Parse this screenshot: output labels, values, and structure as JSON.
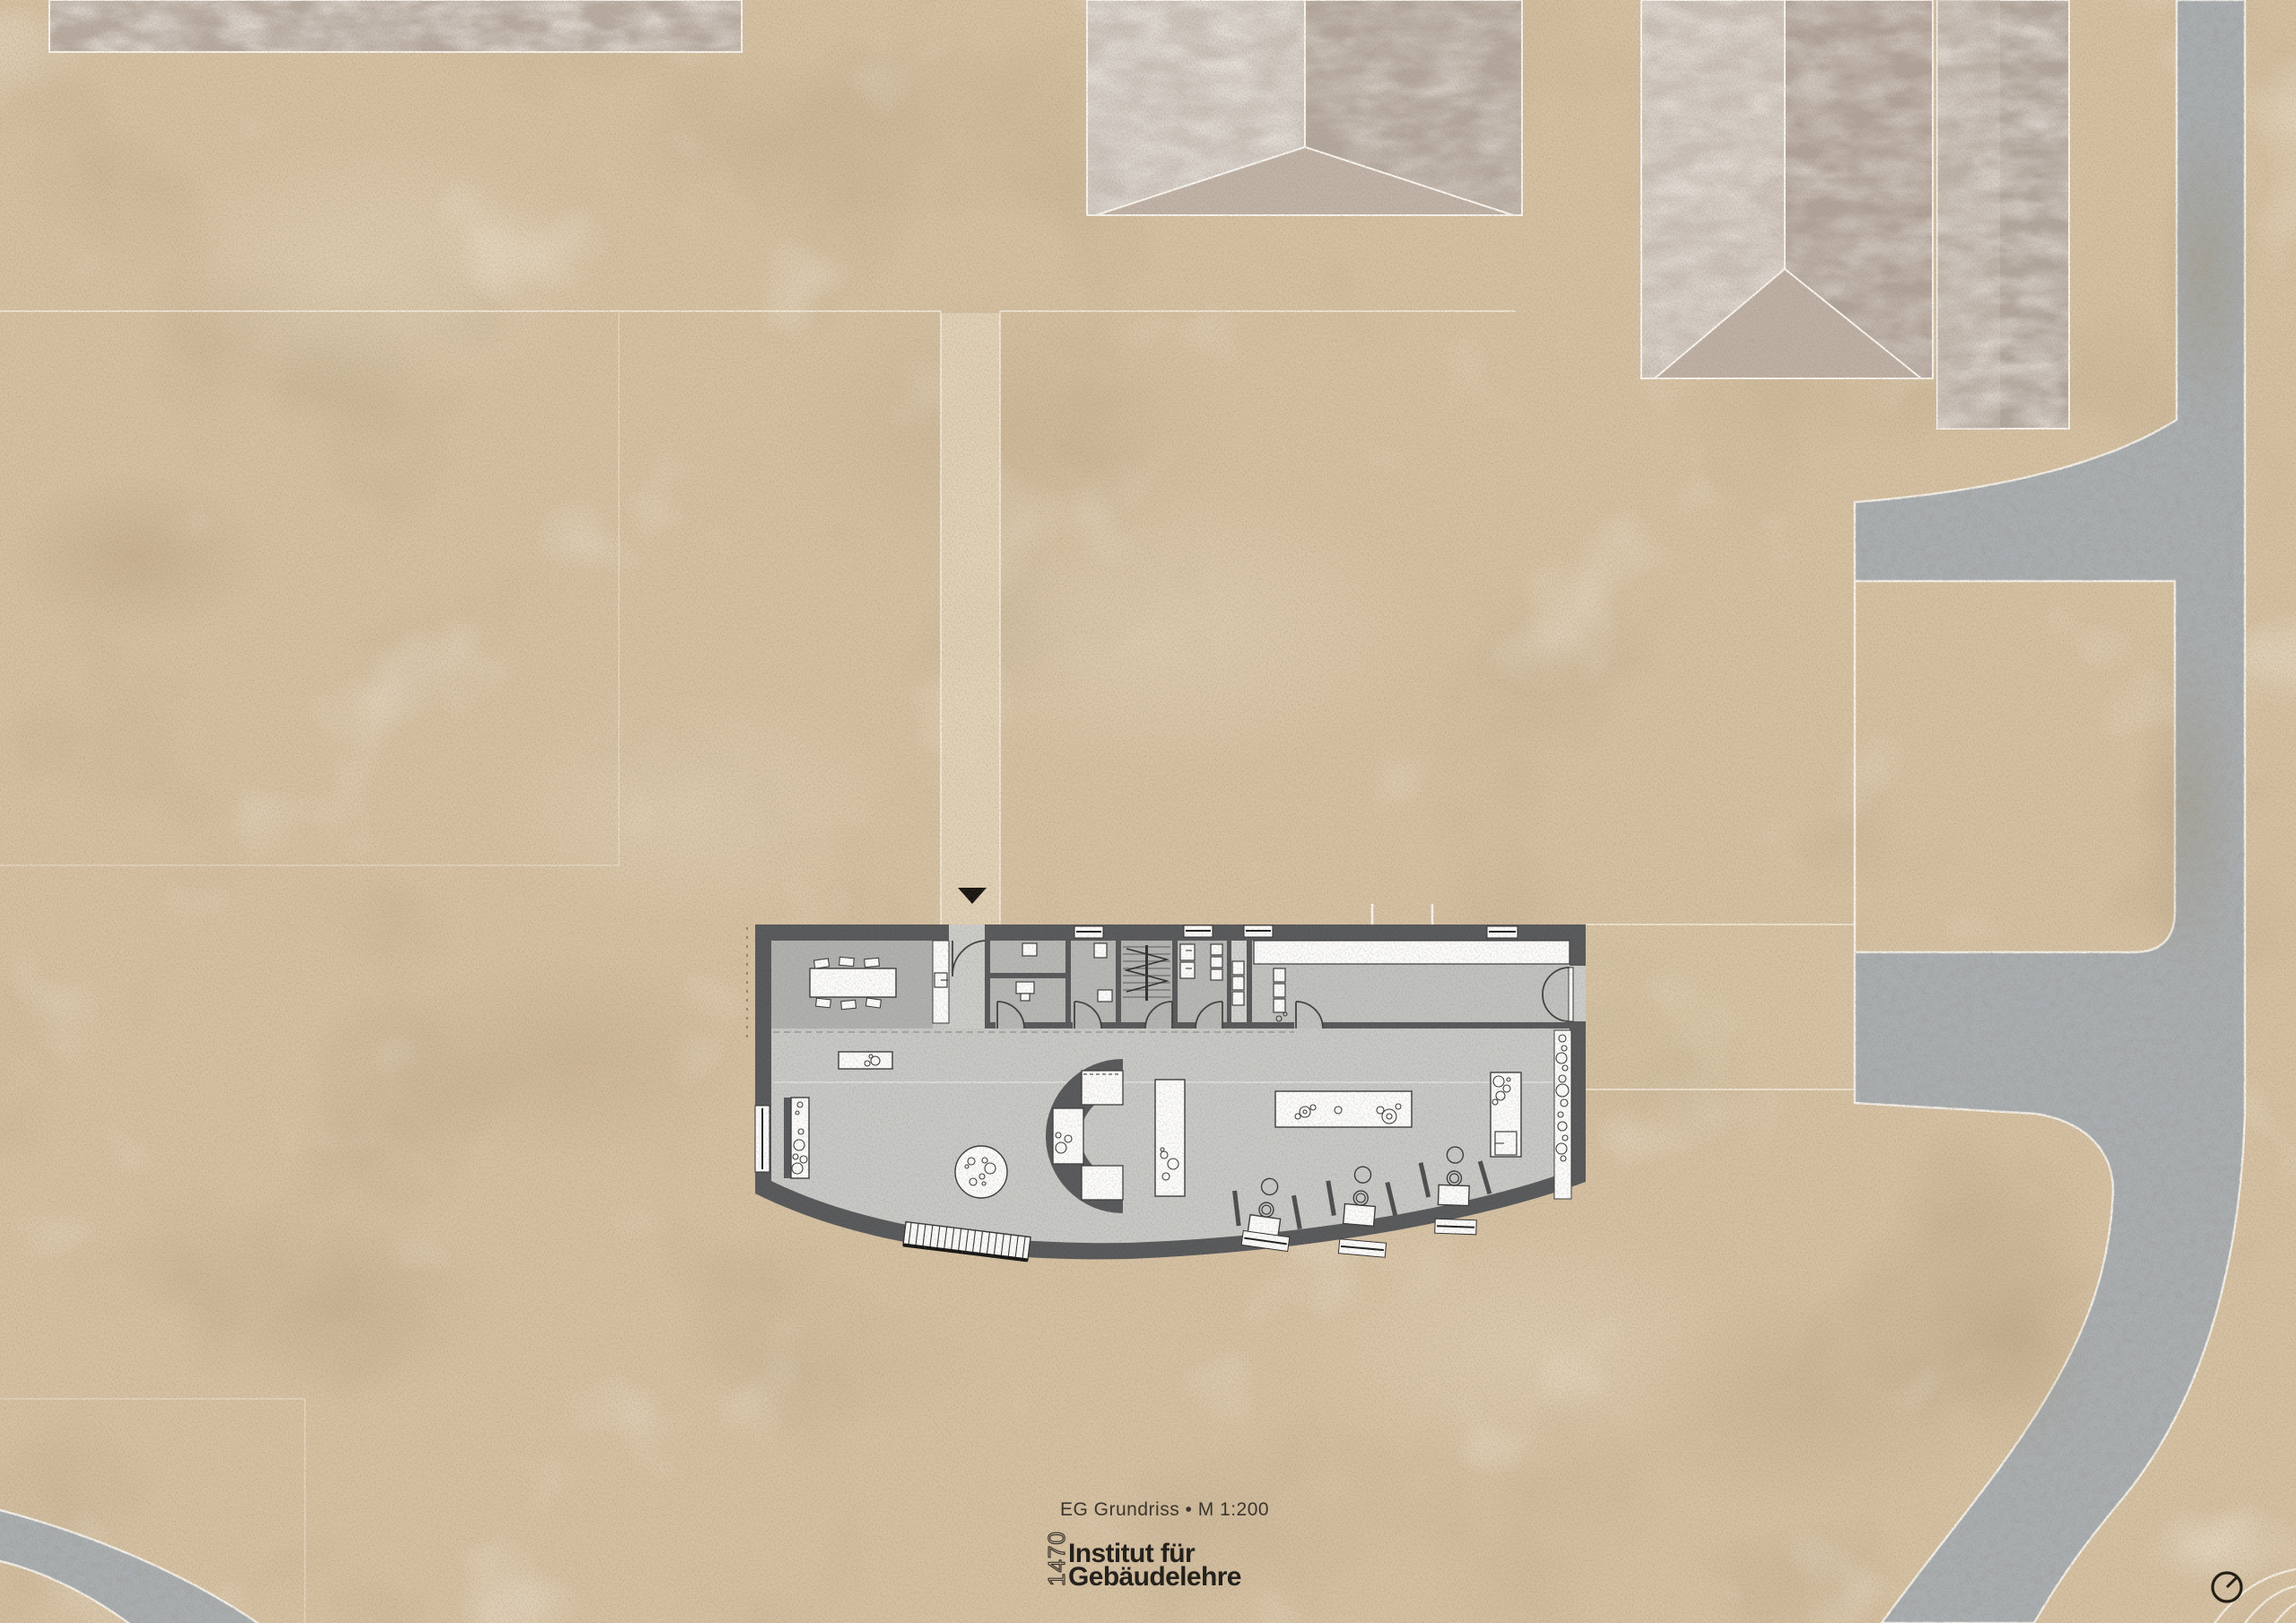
{
  "caption": {
    "text": "EG Grundriss • M 1:200"
  },
  "logo": {
    "number": "1470",
    "name_line1": "Institut für",
    "name_line2": "Gebäudelehre"
  },
  "icons": {
    "north_indicator": "circle-with-needle",
    "entrance_marker": "down-triangle"
  },
  "colors": {
    "sand": "#d7c2a3",
    "sand_light": "#e4d5ba",
    "path": "#e0d1b6",
    "road": "#aab0b4",
    "roof_light": "#cdc5bd",
    "roof_dark": "#b5a89d",
    "roof_hip": "#c1b4a8",
    "wall": "#55575a",
    "floor_hall": "#c9cac8",
    "floor_room": "#b3b5b3",
    "furniture_outline": "#3a3a3a",
    "ink": "#2e2a24"
  }
}
